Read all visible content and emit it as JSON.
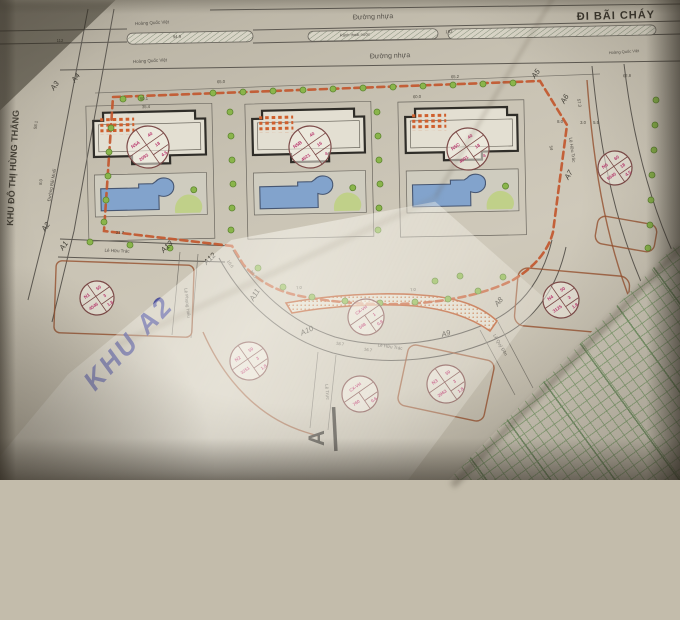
{
  "page": {
    "di_bai_chay": "ĐI BÃI CHÁY",
    "khu_do_thi": "KHU ĐÔ THỊ HÙNG THẮNG",
    "khu_a2": "KHU A2",
    "section_label": "A"
  },
  "colors": {
    "boundary_dash": "#c2572e",
    "lot_label_text": "#b93a6e",
    "pool_fill": "#82a3cc",
    "tree_fill": "#8ab54b",
    "handwriting_ink": "#383d96",
    "table_grid": "#7ca06b"
  },
  "streets": [
    {
      "name": "Hoàng Quốc Việt",
      "x": 152,
      "y": 23,
      "rot": -3,
      "s": 4.5
    },
    {
      "name": "Hoàng Quốc Việt",
      "x": 150,
      "y": 61,
      "rot": -3,
      "s": 4.5
    },
    {
      "name": "Hoàng Quốc Việt",
      "x": 624,
      "y": 52,
      "rot": -4,
      "s": 4
    },
    {
      "name": "Đường nhựa",
      "x": 373,
      "y": 17,
      "rot": -2,
      "s": 7
    },
    {
      "name": "Đường nhựa",
      "x": 390,
      "y": 56,
      "rot": -2,
      "s": 7
    },
    {
      "name": "Rãnh thoát nước",
      "x": 355,
      "y": 35,
      "rot": -2,
      "s": 4
    },
    {
      "name": "Lê Hữu Trác",
      "x": 117,
      "y": 251,
      "rot": 2,
      "s": 4.5
    },
    {
      "name": "Lê Hữu Trác",
      "x": 390,
      "y": 347,
      "rot": 8,
      "s": 4.5
    },
    {
      "name": "Lê Hữu Trác",
      "x": 572,
      "y": 150,
      "rot": 82,
      "s": 4.5
    },
    {
      "name": "Lê Phụng Hiểu",
      "x": 187,
      "y": 303,
      "rot": 84,
      "s": 4.5
    },
    {
      "name": "Lê Trực",
      "x": 327,
      "y": 392,
      "rot": 84,
      "s": 4.5
    },
    {
      "name": "Lê Quý Đôn",
      "x": 500,
      "y": 345,
      "rot": 60,
      "s": 4.5
    },
    {
      "name": "Đường Bãi Muối",
      "x": 52,
      "y": 185,
      "rot": -80,
      "s": 4.5
    }
  ],
  "lots": [
    {
      "id": "N5A",
      "area": "2093",
      "density": "40",
      "floors": "18",
      "coeff": "4.5",
      "x": 148,
      "y": 147,
      "r": 21
    },
    {
      "id": "N5B",
      "area": "4621",
      "density": "40",
      "floors": "16",
      "coeff": "4",
      "x": 310,
      "y": 147,
      "r": 21
    },
    {
      "id": "N5C",
      "area": "4601",
      "density": "40",
      "floors": "18",
      "coeff": "4",
      "x": 468,
      "y": 149,
      "r": 21
    },
    {
      "id": "N6",
      "area": "5640",
      "density": "60",
      "floors": "18",
      "coeff": "4.5",
      "x": 615,
      "y": 168,
      "r": 17
    },
    {
      "id": "N1",
      "area": "4546",
      "density": "50",
      "floors": "3",
      "coeff": "1.8",
      "x": 97,
      "y": 298,
      "r": 17
    },
    {
      "id": "N2",
      "area": "3251",
      "density": "50",
      "floors": "3",
      "coeff": "1.8",
      "x": 249,
      "y": 361,
      "r": 19
    },
    {
      "id": "N3",
      "area": "2963",
      "density": "50",
      "floors": "3",
      "coeff": "1.8",
      "x": 446,
      "y": 384,
      "r": 19
    },
    {
      "id": "N4",
      "area": "3125",
      "density": "50",
      "floors": "3",
      "coeff": "1.8",
      "x": 561,
      "y": 300,
      "r": 18
    },
    {
      "id": "CX-VH",
      "area": "548",
      "density": "",
      "floors": "1",
      "coeff": "0.8",
      "x": 366,
      "y": 317,
      "r": 18
    },
    {
      "id": "CX-VH",
      "area": "760",
      "density": "",
      "floors": "",
      "coeff": "0.6",
      "x": 360,
      "y": 394,
      "r": 18
    }
  ],
  "markers": [
    {
      "id": "A1",
      "x": 64,
      "y": 246,
      "rot": -55
    },
    {
      "id": "A2",
      "x": 46,
      "y": 227,
      "rot": -55
    },
    {
      "id": "A3",
      "x": 55,
      "y": 86,
      "rot": -55
    },
    {
      "id": "A4",
      "x": 76,
      "y": 78,
      "rot": -55
    },
    {
      "id": "A5",
      "x": 536,
      "y": 74,
      "rot": -55
    },
    {
      "id": "A6",
      "x": 565,
      "y": 99,
      "rot": -60
    },
    {
      "id": "A7",
      "x": 569,
      "y": 175,
      "rot": -60
    },
    {
      "id": "A8",
      "x": 499,
      "y": 302,
      "rot": -50
    },
    {
      "id": "A9",
      "x": 446,
      "y": 334,
      "rot": -15
    },
    {
      "id": "A10",
      "x": 307,
      "y": 331,
      "rot": -25
    },
    {
      "id": "A11",
      "x": 255,
      "y": 295,
      "rot": -60
    },
    {
      "id": "A12",
      "x": 210,
      "y": 259,
      "rot": -45
    },
    {
      "id": "A13",
      "x": 167,
      "y": 247,
      "rot": -45
    }
  ],
  "dimensions": [
    {
      "v": "112",
      "x": 60,
      "y": 41,
      "rot": 0
    },
    {
      "v": "94.9",
      "x": 177,
      "y": 37,
      "rot": -2
    },
    {
      "v": "102",
      "x": 449,
      "y": 32,
      "rot": -2
    },
    {
      "v": "65.0",
      "x": 221,
      "y": 82,
      "rot": -2
    },
    {
      "v": "50.1",
      "x": 144,
      "y": 99,
      "rot": -2
    },
    {
      "v": "35.4",
      "x": 146,
      "y": 107,
      "rot": -2
    },
    {
      "v": "60.0",
      "x": 417,
      "y": 97,
      "rot": -2
    },
    {
      "v": "65.2",
      "x": 455,
      "y": 77,
      "rot": -2
    },
    {
      "v": "62.8",
      "x": 627,
      "y": 76,
      "rot": -2
    },
    {
      "v": "57.3",
      "x": 579,
      "y": 103,
      "rot": 80
    },
    {
      "v": "8.0",
      "x": 560,
      "y": 122,
      "rot": 0
    },
    {
      "v": "3.0",
      "x": 583,
      "y": 123,
      "rot": 0
    },
    {
      "v": "5.5",
      "x": 596,
      "y": 123,
      "rot": 0
    },
    {
      "v": "54",
      "x": 551,
      "y": 148,
      "rot": 78
    },
    {
      "v": "21.7",
      "x": 120,
      "y": 233,
      "rot": 0
    },
    {
      "v": "18.7",
      "x": 340,
      "y": 344,
      "rot": 8
    },
    {
      "v": "16.7",
      "x": 368,
      "y": 350,
      "rot": 8
    },
    {
      "v": "7.0",
      "x": 299,
      "y": 288,
      "rot": -5
    },
    {
      "v": "7.0",
      "x": 413,
      "y": 290,
      "rot": -5
    },
    {
      "v": "58.1",
      "x": 36,
      "y": 125,
      "rot": -82
    },
    {
      "v": "8.0",
      "x": 41,
      "y": 182,
      "rot": -82
    },
    {
      "v": "36.0",
      "x": 253,
      "y": 274,
      "rot": 55
    },
    {
      "v": "10.0",
      "x": 230,
      "y": 264,
      "rot": 55
    }
  ]
}
